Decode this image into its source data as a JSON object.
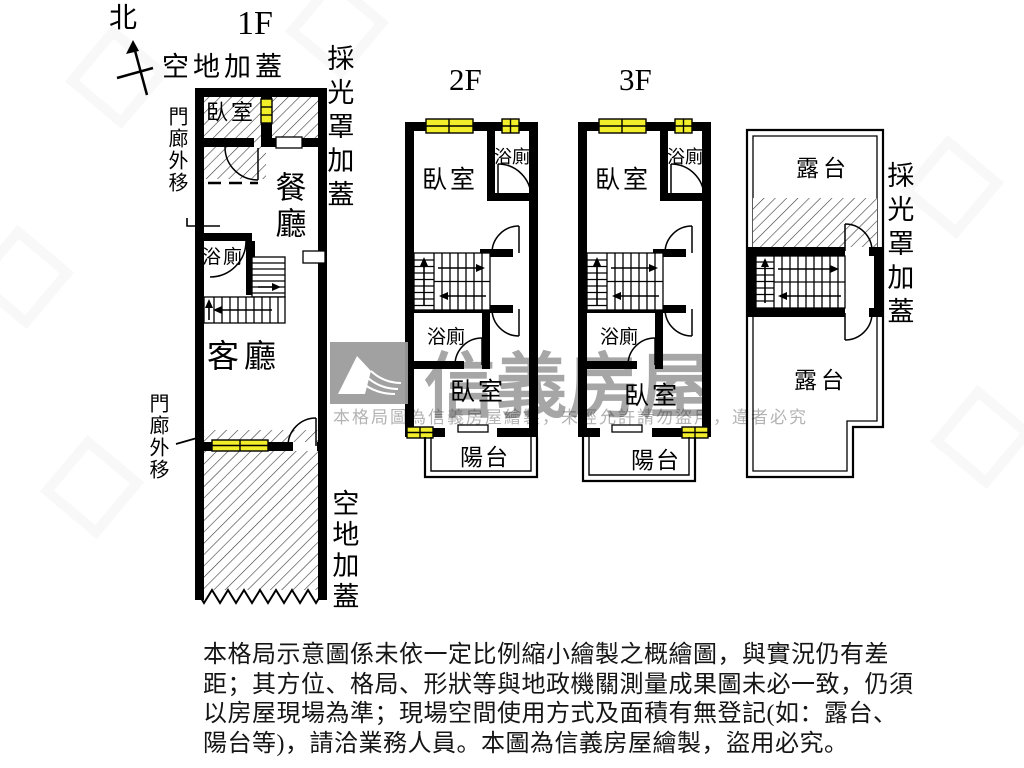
{
  "colors": {
    "wall": "#000000",
    "window_yellow": "#f2ee2a",
    "hatch_line": "#3a3a3a",
    "watermark_gray": "#a6a6a6",
    "logo_gray": "#9c9c9c"
  },
  "compass": {
    "label": "北"
  },
  "floor1": {
    "title": "1F",
    "label_open_top": "空地加蓋",
    "label_canopy": "採光罩加蓋",
    "label_porch_top": "門廊外移",
    "label_porch_bottom": "門廊外移",
    "label_open_bottom": "空地加蓋",
    "room_bedroom": "臥室",
    "room_dining": "餐廳",
    "room_bath": "浴廁",
    "room_living": "客廳"
  },
  "floor2": {
    "title": "2F",
    "room_bedroom_top": "臥室",
    "room_bath_top": "浴廁",
    "room_bath_mid": "浴廁",
    "room_bedroom_bottom": "臥室",
    "room_balcony": "陽台"
  },
  "floor3": {
    "title": "3F",
    "room_bedroom_top": "臥室",
    "room_bath_top": "浴廁",
    "room_bath_mid": "浴廁",
    "room_bedroom_bottom": "臥室",
    "room_balcony": "陽台"
  },
  "roof": {
    "label_canopy": "採光罩加蓋",
    "room_terrace_top": "露台",
    "room_terrace_bottom": "露台"
  },
  "watermark": {
    "brand": "信義房屋",
    "notice": "本格局圖為信義房屋繪製，未經允許請勿盜用，違者必究"
  },
  "disclaimer": {
    "line1": "本格局示意圖係未依一定比例縮小繪製之概繪圖，與實況仍有差",
    "line2": "距；其方位、格局、形狀等與地政機關測量成果圖未必一致，仍須",
    "line3": "以房屋現場為準；現場空間使用方式及面積有無登記(如：露台、",
    "line4": "陽台等)，請洽業務人員。本圖為信義房屋繪製，盜用必究。"
  }
}
